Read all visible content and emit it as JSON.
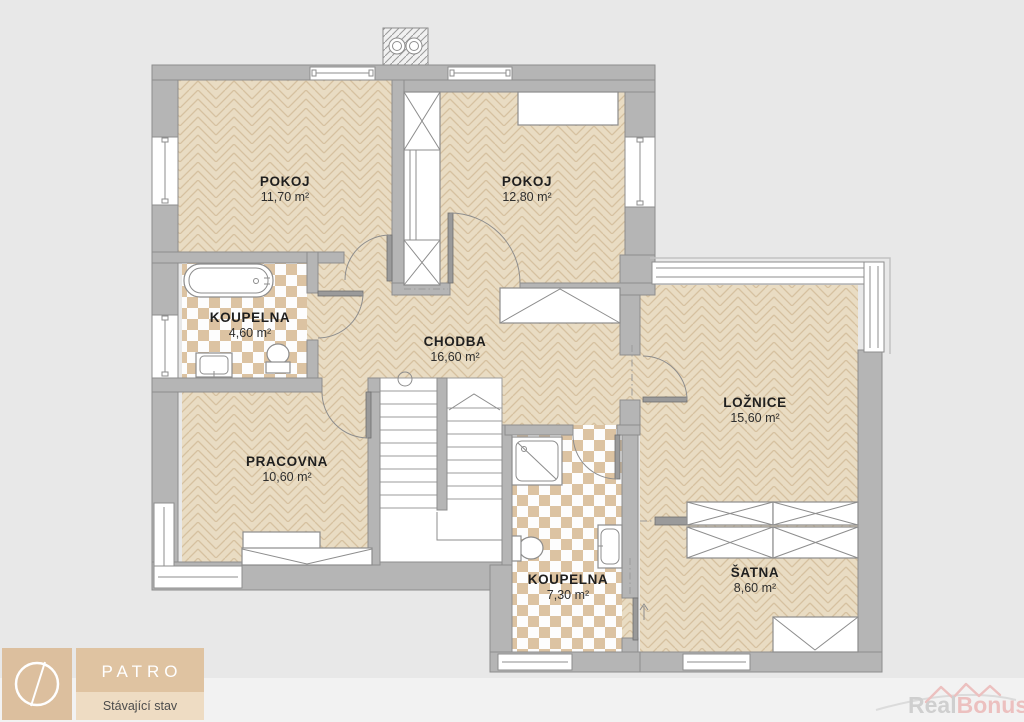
{
  "rooms": [
    {
      "name": "POKOJ",
      "area": "11,70 m²"
    },
    {
      "name": "POKOJ",
      "area": "12,80 m²"
    },
    {
      "name": "KOUPELNA",
      "area": "4,60 m²"
    },
    {
      "name": "CHODBA",
      "area": "16,60 m²"
    },
    {
      "name": "PRACOVNA",
      "area": "10,60 m²"
    },
    {
      "name": "LOŽNICE",
      "area": "15,60 m²"
    },
    {
      "name": "KOUPELNA",
      "area": "7,30 m²"
    },
    {
      "name": "ŠATNA",
      "area": "8,60 m²"
    }
  ],
  "title_block": {
    "floor_label": "PATRO",
    "status_label": "Stávající stav"
  },
  "watermark": {
    "part1": "Real",
    "part2": "Bonus",
    "suffix": ".cz"
  },
  "colors": {
    "wall": "#b5b5b5",
    "wall_stroke": "#8d8d8d",
    "parquet_base": "#e9dcc3",
    "parquet_line": "#d6c1a0",
    "tile_accent": "#dcc3a2",
    "background": "#e8e8e8",
    "background_lower": "#f2f2f2",
    "legend_tan": "#dcbf9e",
    "legend_band": "#dfc3a1",
    "legend_band_light": "#eedcc3",
    "watermark_gray": "#bdbdbd",
    "watermark_pink": "#eaa6a4"
  }
}
